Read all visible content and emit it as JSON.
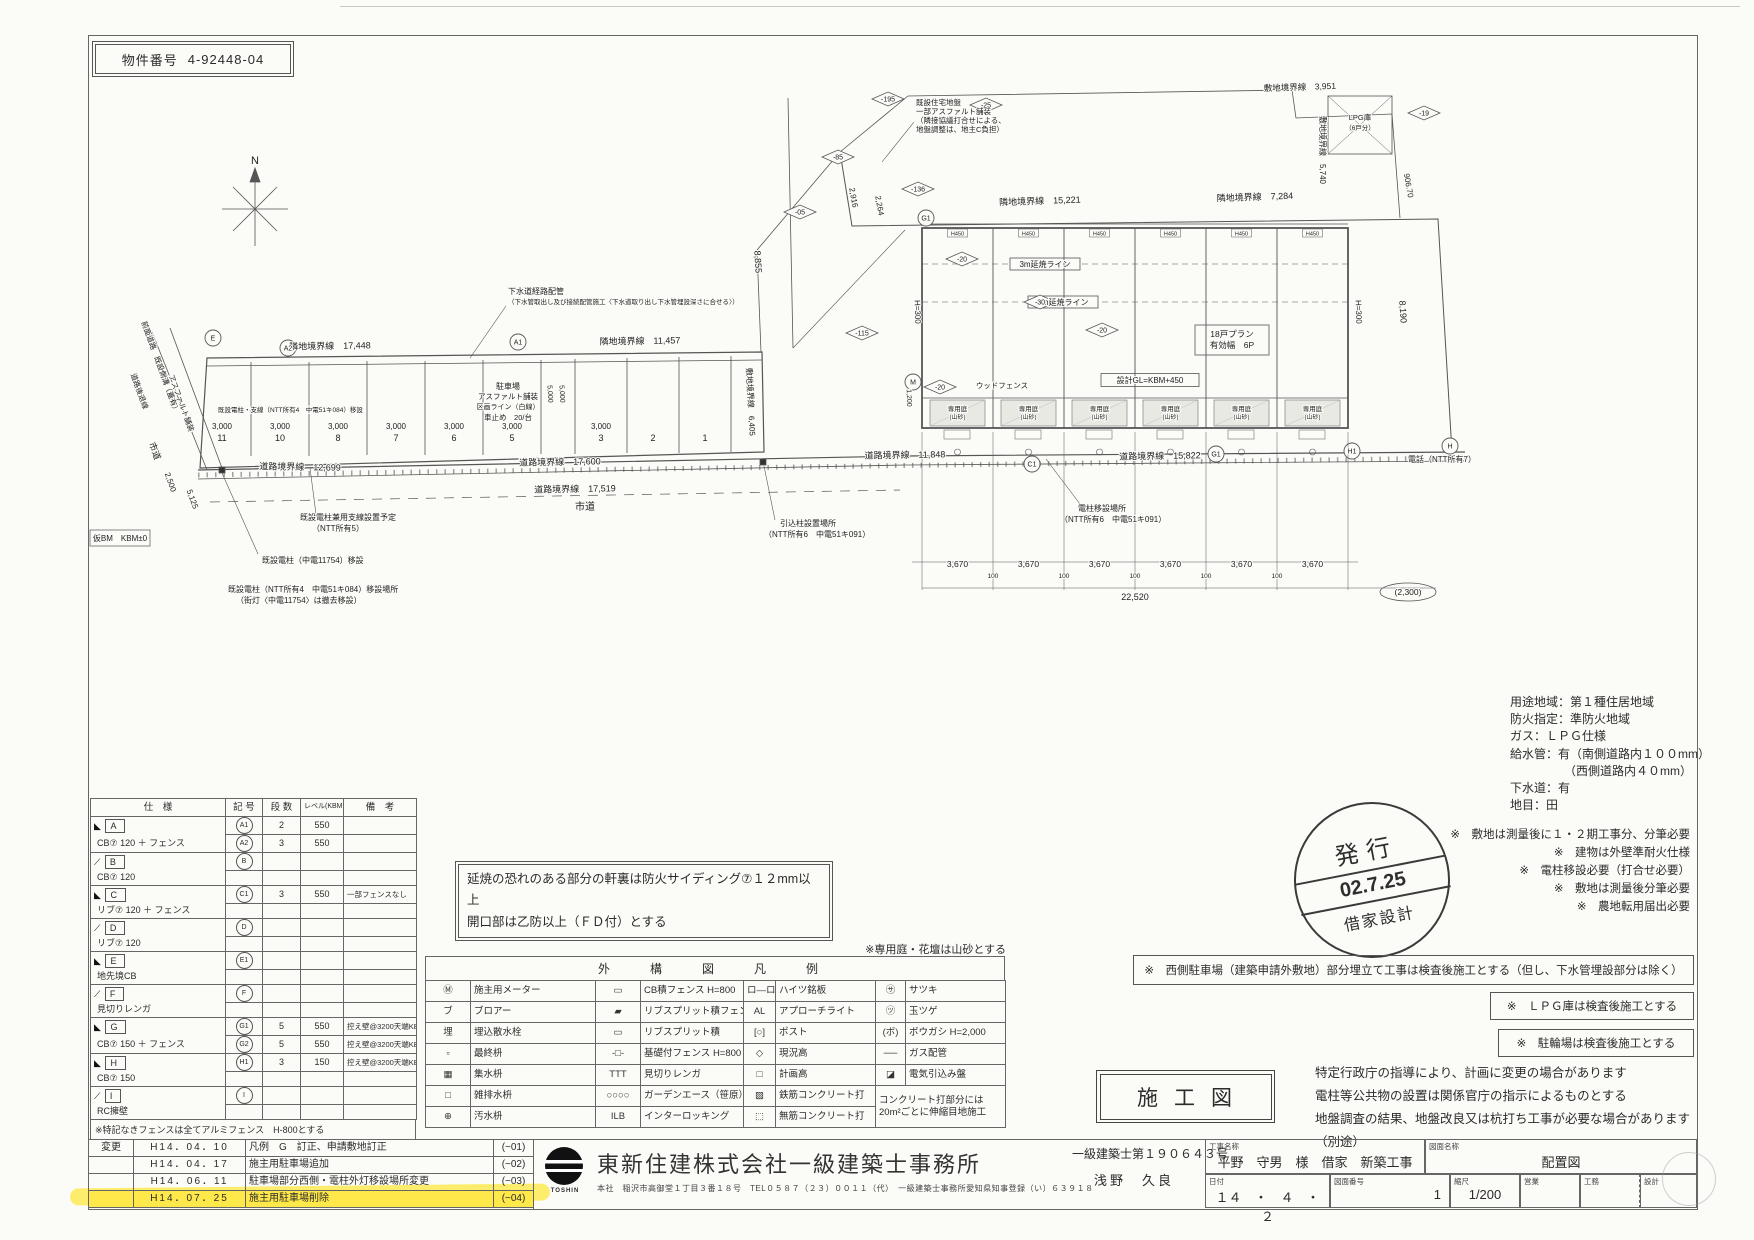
{
  "property": {
    "label": "物件番号",
    "number": "4-92448-04"
  },
  "plan": {
    "labels": [
      {
        "t": "N",
        "x": 255,
        "y": 164,
        "s": 11,
        "a": "m"
      },
      {
        "t": "隣地境界線　17,448",
        "x": 330,
        "y": 349,
        "s": 9,
        "a": "m",
        "r": -1
      },
      {
        "t": "隣地境界線　11,457",
        "x": 640,
        "y": 344,
        "s": 9,
        "a": "m",
        "r": -1
      },
      {
        "t": "隣地境界線　15,221",
        "x": 1040,
        "y": 204,
        "s": 9,
        "a": "m",
        "r": -2
      },
      {
        "t": "隣地境界線　7,284",
        "x": 1255,
        "y": 200,
        "s": 9,
        "a": "m",
        "r": -2
      },
      {
        "t": "敷地境界線　3,951",
        "x": 1300,
        "y": 90,
        "s": 8.5,
        "a": "m",
        "r": -2
      },
      {
        "t": "敷地境界線　5,740",
        "x": 1320,
        "y": 150,
        "s": 8,
        "a": "m",
        "r": 90
      },
      {
        "t": "906.70",
        "x": 1406,
        "y": 186,
        "s": 8,
        "a": "m",
        "r": 80
      },
      {
        "t": "8,190",
        "x": 1400,
        "y": 312,
        "s": 9,
        "a": "m",
        "r": 86
      },
      {
        "t": "8,855",
        "x": 755,
        "y": 262,
        "s": 9,
        "a": "m",
        "r": 87
      },
      {
        "t": "敷地境界線　6,405",
        "x": 748,
        "y": 402,
        "s": 8,
        "a": "m",
        "r": 87
      },
      {
        "t": "2,916",
        "x": 851,
        "y": 198,
        "s": 8,
        "a": "m",
        "r": 80
      },
      {
        "t": "2,264",
        "x": 877,
        "y": 206,
        "s": 8,
        "a": "m",
        "r": 80
      },
      {
        "t": "道路境界線　12,699",
        "x": 300,
        "y": 470,
        "s": 9,
        "a": "m",
        "r": 1
      },
      {
        "t": "道路境界線　17,600",
        "x": 560,
        "y": 465,
        "s": 9,
        "a": "m",
        "r": -1
      },
      {
        "t": "道路境界線　17,519",
        "x": 575,
        "y": 492,
        "s": 9,
        "a": "m",
        "r": -1
      },
      {
        "t": "道路境界線　11,848",
        "x": 905,
        "y": 458,
        "s": 9,
        "a": "m",
        "r": -1
      },
      {
        "t": "道路境界線　15,822",
        "x": 1160,
        "y": 459,
        "s": 9,
        "a": "m",
        "r": -1
      },
      {
        "t": "市道",
        "x": 585,
        "y": 510,
        "s": 10,
        "a": "m"
      },
      {
        "t": "市道",
        "x": 152,
        "y": 452,
        "s": 9,
        "a": "m",
        "r": 70
      },
      {
        "t": "2,500",
        "x": 168,
        "y": 483,
        "s": 8,
        "a": "m",
        "r": 70
      },
      {
        "t": "5,125",
        "x": 190,
        "y": 500,
        "s": 8,
        "a": "m",
        "r": 70
      },
      {
        "t": "前面道路　既設側溝（蓋有）",
        "x": 158,
        "y": 368,
        "s": 7.5,
        "a": "m",
        "r": 70
      },
      {
        "t": "アスファルト舗装",
        "x": 179,
        "y": 404,
        "s": 7.5,
        "a": "m",
        "r": 70
      },
      {
        "t": "道路後退線",
        "x": 137,
        "y": 392,
        "s": 7.5,
        "a": "m",
        "r": 70
      },
      {
        "t": "仮BM　KBM±0",
        "x": 120,
        "y": 541,
        "s": 8,
        "a": "m"
      },
      {
        "t": "駐車場",
        "x": 508,
        "y": 389,
        "s": 8,
        "a": "m"
      },
      {
        "t": "アスファルト舗装",
        "x": 508,
        "y": 399,
        "s": 7.5,
        "a": "m"
      },
      {
        "t": "区画ライン（白線）",
        "x": 508,
        "y": 409,
        "s": 7,
        "a": "m"
      },
      {
        "t": "車止め　20/台",
        "x": 508,
        "y": 420,
        "s": 7.5,
        "a": "m"
      },
      {
        "t": "既設電柱・支線（NTT所有4　中電51キ084）移設",
        "x": 218,
        "y": 412,
        "s": 6.5
      },
      {
        "t": "5,000",
        "x": 548,
        "y": 394,
        "s": 7,
        "a": "m",
        "r": 87
      },
      {
        "t": "5,000",
        "x": 560,
        "y": 394,
        "s": 7,
        "a": "m",
        "r": 87
      },
      {
        "t": "ウッドフェンス",
        "x": 1002,
        "y": 388,
        "s": 7.5,
        "a": "m"
      },
      {
        "t": "H=300",
        "x": 915,
        "y": 312,
        "s": 8,
        "a": "m",
        "r": 88
      },
      {
        "t": "H=300",
        "x": 1356,
        "y": 312,
        "s": 8,
        "a": "m",
        "r": 88
      },
      {
        "t": "1,200",
        "x": 907,
        "y": 398,
        "s": 7,
        "a": "m",
        "r": 88
      },
      {
        "t": "22,520",
        "x": 1135,
        "y": 600,
        "s": 9,
        "a": "m"
      },
      {
        "t": "電話（NTT所有7）",
        "x": 1408,
        "y": 462,
        "s": 8
      },
      {
        "t": "既設電柱（中電11754）移設",
        "x": 262,
        "y": 563,
        "s": 8
      },
      {
        "t": "既設電柱（NTT所有4　中電51キ084）移設場所",
        "x": 228,
        "y": 592,
        "s": 8
      },
      {
        "t": "（街灯〈中電11754〉は撤去移設）",
        "x": 236,
        "y": 603,
        "s": 8
      },
      {
        "t": "既設電柱兼用支線設置予定",
        "x": 300,
        "y": 520,
        "s": 8
      },
      {
        "t": "（NTT所有5）",
        "x": 312,
        "y": 531,
        "s": 8
      },
      {
        "t": "引込柱設置場所",
        "x": 780,
        "y": 526,
        "s": 8
      },
      {
        "t": "（NTT所有6　中電51キ091）",
        "x": 764,
        "y": 537,
        "s": 8
      },
      {
        "t": "電柱移設場所",
        "x": 1078,
        "y": 511,
        "s": 8
      },
      {
        "t": "（NTT所有6　中電51キ091）",
        "x": 1060,
        "y": 522,
        "s": 8
      },
      {
        "t": "下水道経路配管",
        "x": 508,
        "y": 294,
        "s": 8
      },
      {
        "t": "（下水管取出し及び接続配管施工〈下水道取り出し下水管埋設深さに合せる〉）",
        "x": 508,
        "y": 304,
        "s": 6.5
      },
      {
        "t": "既設住宅地盤",
        "x": 916,
        "y": 105,
        "s": 7.5
      },
      {
        "t": "一部アスファルト舗装",
        "x": 916,
        "y": 114,
        "s": 7.5
      },
      {
        "t": "（隣接協議打合せによる、",
        "x": 916,
        "y": 123,
        "s": 7.5
      },
      {
        "t": "地盤調整は、地主C負担）",
        "x": 916,
        "y": 132,
        "s": 7.5
      },
      {
        "t": "LPG庫",
        "x": 1360,
        "y": 120,
        "s": 7.5,
        "a": "m"
      },
      {
        "t": "（6戸分）",
        "x": 1360,
        "y": 130,
        "s": 6.5,
        "a": "m"
      }
    ],
    "boxes": [
      {
        "t": "3m延焼ライン",
        "x": 1045,
        "y": 264,
        "w": 70,
        "h": 12,
        "s": 8
      },
      {
        "t": "5m延焼ライン",
        "x": 1063,
        "y": 302,
        "w": 70,
        "h": 12,
        "s": 8
      },
      {
        "t": "設計GL=KBM+450",
        "x": 1150,
        "y": 380,
        "w": 98,
        "h": 13,
        "s": 8
      },
      {
        "t": "18戸プラン",
        "t2": "有効幅　6P",
        "x": 1232,
        "y": 340,
        "w": 74,
        "h": 30,
        "s": 8.5
      }
    ],
    "diamonds": [
      {
        "v": "-195",
        "x": 888,
        "y": 99
      },
      {
        "v": "-25",
        "x": 986,
        "y": 105
      },
      {
        "v": "-85",
        "x": 838,
        "y": 157
      },
      {
        "v": "-136",
        "x": 918,
        "y": 189
      },
      {
        "v": "-20",
        "x": 962,
        "y": 259
      },
      {
        "v": "-30",
        "x": 1040,
        "y": 302
      },
      {
        "v": "-20",
        "x": 1102,
        "y": 330
      },
      {
        "v": "-20",
        "x": 940,
        "y": 387
      },
      {
        "v": "-115",
        "x": 862,
        "y": 333
      },
      {
        "v": "-19",
        "x": 1424,
        "y": 113
      },
      {
        "v": "-05",
        "x": 800,
        "y": 212
      }
    ],
    "refs": [
      {
        "v": "E",
        "x": 213,
        "y": 338
      },
      {
        "v": "A2",
        "x": 288,
        "y": 348
      },
      {
        "v": "A1",
        "x": 518,
        "y": 342
      },
      {
        "v": "M",
        "x": 913,
        "y": 382
      },
      {
        "v": "C1",
        "x": 1032,
        "y": 464
      },
      {
        "v": "G1",
        "x": 1216,
        "y": 454
      },
      {
        "v": "H1",
        "x": 1352,
        "y": 451
      },
      {
        "v": "G1",
        "x": 926,
        "y": 218
      },
      {
        "v": "H",
        "x": 1450,
        "y": 446
      }
    ],
    "ovals": [
      {
        "v": "(2,300)",
        "x": 1408,
        "y": 592,
        "w": 56,
        "h": 18,
        "s": 8.5
      }
    ],
    "stalls": {
      "dim": "3,000",
      "numbers": [
        {
          "n": "11",
          "x": 222,
          "d": 1
        },
        {
          "n": "10",
          "x": 280,
          "d": 1
        },
        {
          "n": "8",
          "x": 338,
          "d": 1
        },
        {
          "n": "7",
          "x": 396,
          "d": 1
        },
        {
          "n": "6",
          "x": 454,
          "d": 1
        },
        {
          "n": "5",
          "x": 512,
          "d": 1
        },
        {
          "n": "3",
          "x": 601,
          "d": 1
        },
        {
          "n": "2",
          "x": 653
        },
        {
          "n": "1",
          "x": 705
        }
      ]
    },
    "bays": {
      "x": [
        922,
        993,
        1064,
        1135,
        1206,
        1277
      ],
      "w": 71,
      "dim_bay": "3,670",
      "dim_gap": "100",
      "h450": "H450",
      "garden1": "専用庭",
      "garden2": "(山砂)"
    }
  },
  "spec_table": {
    "headers": [
      "仕　様",
      "記 号",
      "段 数",
      "レベル(KBM+)",
      "備　考"
    ],
    "groups": [
      {
        "mark": "◣",
        "letter": "A",
        "spec": "CB⑦ 120 ＋ フェンス",
        "lines": [
          {
            "sym": "A1",
            "steps": "2",
            "level": "550",
            "note": ""
          },
          {
            "sym": "A2",
            "steps": "3",
            "level": "550",
            "note": ""
          }
        ]
      },
      {
        "mark": "⟋",
        "letter": "B",
        "spec": "CB⑦ 120",
        "lines": [
          {
            "sym": "B",
            "steps": "",
            "level": "",
            "note": ""
          }
        ]
      },
      {
        "mark": "◣",
        "letter": "C",
        "spec": "リブ⑦ 120 ＋ フェンス",
        "lines": [
          {
            "sym": "C1",
            "steps": "3",
            "level": "550",
            "note": "一部フェンスなし"
          }
        ]
      },
      {
        "mark": "⟋",
        "letter": "D",
        "spec": "リブ⑦ 120",
        "lines": [
          {
            "sym": "D",
            "steps": "",
            "level": "",
            "note": ""
          }
        ]
      },
      {
        "mark": "◣",
        "letter": "E",
        "spec": "地先境CB",
        "lines": [
          {
            "sym": "E1",
            "steps": "",
            "level": "",
            "note": ""
          }
        ]
      },
      {
        "mark": "⟋",
        "letter": "F",
        "spec": "見切りレンガ",
        "lines": [
          {
            "sym": "F",
            "steps": "",
            "level": "",
            "note": ""
          }
        ]
      },
      {
        "mark": "◣",
        "letter": "G",
        "spec": "CB⑦ 150 ＋ フェンス",
        "lines": [
          {
            "sym": "G1",
            "steps": "5",
            "level": "550",
            "note": "控え壁@3200天端KBM+350"
          },
          {
            "sym": "G2",
            "steps": "5",
            "level": "550",
            "note": "控え壁@3200天端KBM+350〜-50"
          }
        ]
      },
      {
        "mark": "◣",
        "letter": "H",
        "spec": "CB⑦ 150",
        "lines": [
          {
            "sym": "H1",
            "steps": "3",
            "level": "150",
            "note": "控え壁@3200天端KBM-50"
          }
        ]
      },
      {
        "mark": "⟋",
        "letter": "I",
        "spec": "RC擁壁",
        "lines": [
          {
            "sym": "I",
            "steps": "",
            "level": "",
            "note": ""
          }
        ]
      }
    ],
    "footnote": "※特記なきフェンスは全てアルミフェンス　H-800とする"
  },
  "fire_note": {
    "line1": "延焼の恐れのある部分の軒裏は防火サイディング⑦１２mm以上",
    "line2": "開口部は乙防以上（ＦＤ付）とする"
  },
  "garden_note": "※専用庭・花壇は山砂とする",
  "legend": {
    "title": "外　構　図　凡　例",
    "rows": [
      [
        "Ⓜ",
        "施主用メーター",
        "▭",
        "CB積フェンス H=800",
        "ロ—ロ",
        "ハイツ銘板",
        "㋚",
        "サツキ"
      ],
      [
        "ブ",
        "ブロアー",
        "▰",
        "リブスプリット積フェンス H=800",
        "AL",
        "アプローチライト",
        "㋡",
        "玉ツゲ"
      ],
      [
        "埋",
        "埋込散水栓",
        "▭",
        "リブスプリット積",
        "[○]",
        "ポスト",
        "(ボ)",
        "ボウガシ H=2,000"
      ],
      [
        "▫",
        "最終枡",
        "‐□‐",
        "基礎付フェンス H=800",
        "◇",
        "現況高",
        "──",
        "ガス配管"
      ],
      [
        "▦",
        "集水枡",
        "ΤΤΤ",
        "見切りレンガ",
        "□",
        "計画高",
        "◪",
        "電気引込み盤"
      ],
      [
        "□",
        "雑排水枡",
        "○○○○",
        "ガーデンエース（笹原）",
        "▨",
        "鉄筋コンクリート打",
        "",
        ""
      ],
      [
        "⊕",
        "汚水枡",
        "ILB",
        "インターロッキング",
        "⬚",
        "無筋コンクリート打",
        "",
        ""
      ]
    ],
    "concrete_note": "コンクリート打部分には20m²ごとに伸縮目地施工"
  },
  "util_notes": [
    "用途地域：第１種住居地域",
    "防火指定：準防火地域",
    "ガス：ＬＰＧ仕様",
    "給水管：有（南側道路内１００mm）",
    "　　　　　（西側道路内４０mm）",
    "下水道：有",
    "地目：田"
  ],
  "misc_notes": [
    "※　敷地は測量後に１・２期工事分、分筆必要",
    "※　建物は外壁準耐火仕様",
    "※　電柱移設必要（打合せ必要）",
    "※　敷地は測量後分筆必要",
    "※　農地転用届出必要"
  ],
  "stamp": {
    "line1": "発行",
    "line2": "02.7.25",
    "line3": "借家設計"
  },
  "boxed_notes": [
    "※　西側駐車場（建築申請外敷地）部分埋立て工事は検査後施工とする（但し、下水管埋設部分は除く）",
    "※　ＬＰＧ庫は検査後施工とする",
    "※　駐輪場は検査後施工とする"
  ],
  "sekou_label": "施工図",
  "disclaimer": [
    "特定行政庁の指導により、計画に変更の場合があります",
    "電柱等公共物の設置は関係官庁の指示によるものとする",
    "地盤調査の結果、地盤改良又は杭打ち工事が必要な場合があります（別途）"
  ],
  "revisions": {
    "label": "変更",
    "rows": [
      {
        "date": "H14．04．10",
        "desc": "凡例　G　訂正、申請敷地訂正",
        "code": "(−01)"
      },
      {
        "date": "H14．04．17",
        "desc": "施主用駐車場追加",
        "code": "(−02)"
      },
      {
        "date": "H14．06．11",
        "desc": "駐車場部分西側・電柱外灯移設場所変更",
        "code": "(−03)"
      },
      {
        "date": "H14．07．25",
        "desc": "施主用駐車場削除",
        "code": "(−04)",
        "highlight": true
      }
    ]
  },
  "title_block": {
    "company": "東新住建株式会社一級建築士事務所",
    "logo_text": "TOSHIN",
    "address": "本社　稲沢市高御堂１丁目３番１８号　TEL０５８７（２３）００１１（代）　一級建築士事務所愛知県知事登録（い）６３９１８",
    "license": "一級建築士第１９０６４３号",
    "architect": "浅野　久良",
    "labels": {
      "project": "工事名称",
      "drawing": "図面名称",
      "date": "日付",
      "number": "図面番号",
      "scale": "縮尺",
      "sales": "営業",
      "works": "工務",
      "design": "設計"
    },
    "values": {
      "project": "平野　守男　様　借家　新築工事",
      "drawing": "配置図",
      "date": "１４　・　４　・　２",
      "number": "1",
      "scale": "1/200"
    }
  }
}
